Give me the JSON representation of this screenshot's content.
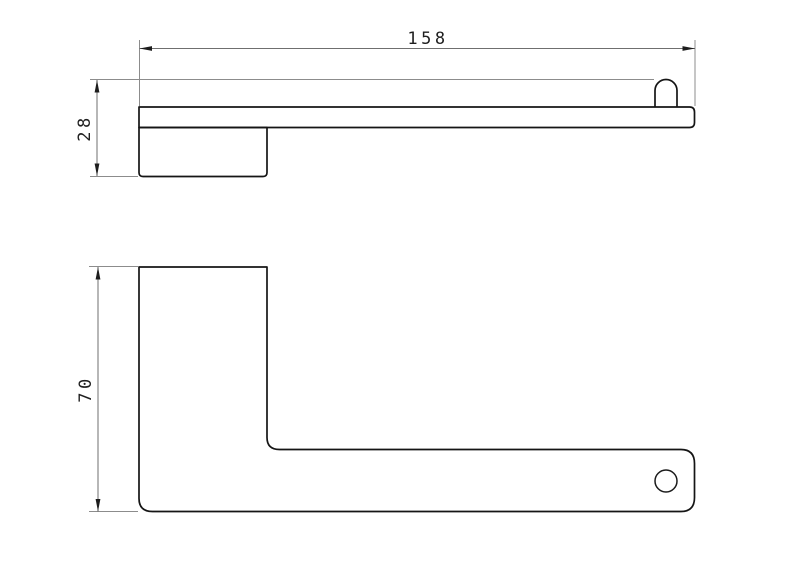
{
  "drawing": {
    "dimensions": {
      "length": {
        "value": "158",
        "orientation": "horizontal",
        "view": "top-view"
      },
      "depth": {
        "value": "28",
        "orientation": "vertical",
        "view": "top-view"
      },
      "height": {
        "value": "70",
        "orientation": "vertical",
        "view": "front-view"
      }
    },
    "colors": {
      "background": "#ffffff",
      "part_outline": "#151515",
      "dimension_line": "#6f6f6f",
      "extension_line": "#8c8c8c",
      "dimension_text": "#1f1f1f"
    }
  }
}
